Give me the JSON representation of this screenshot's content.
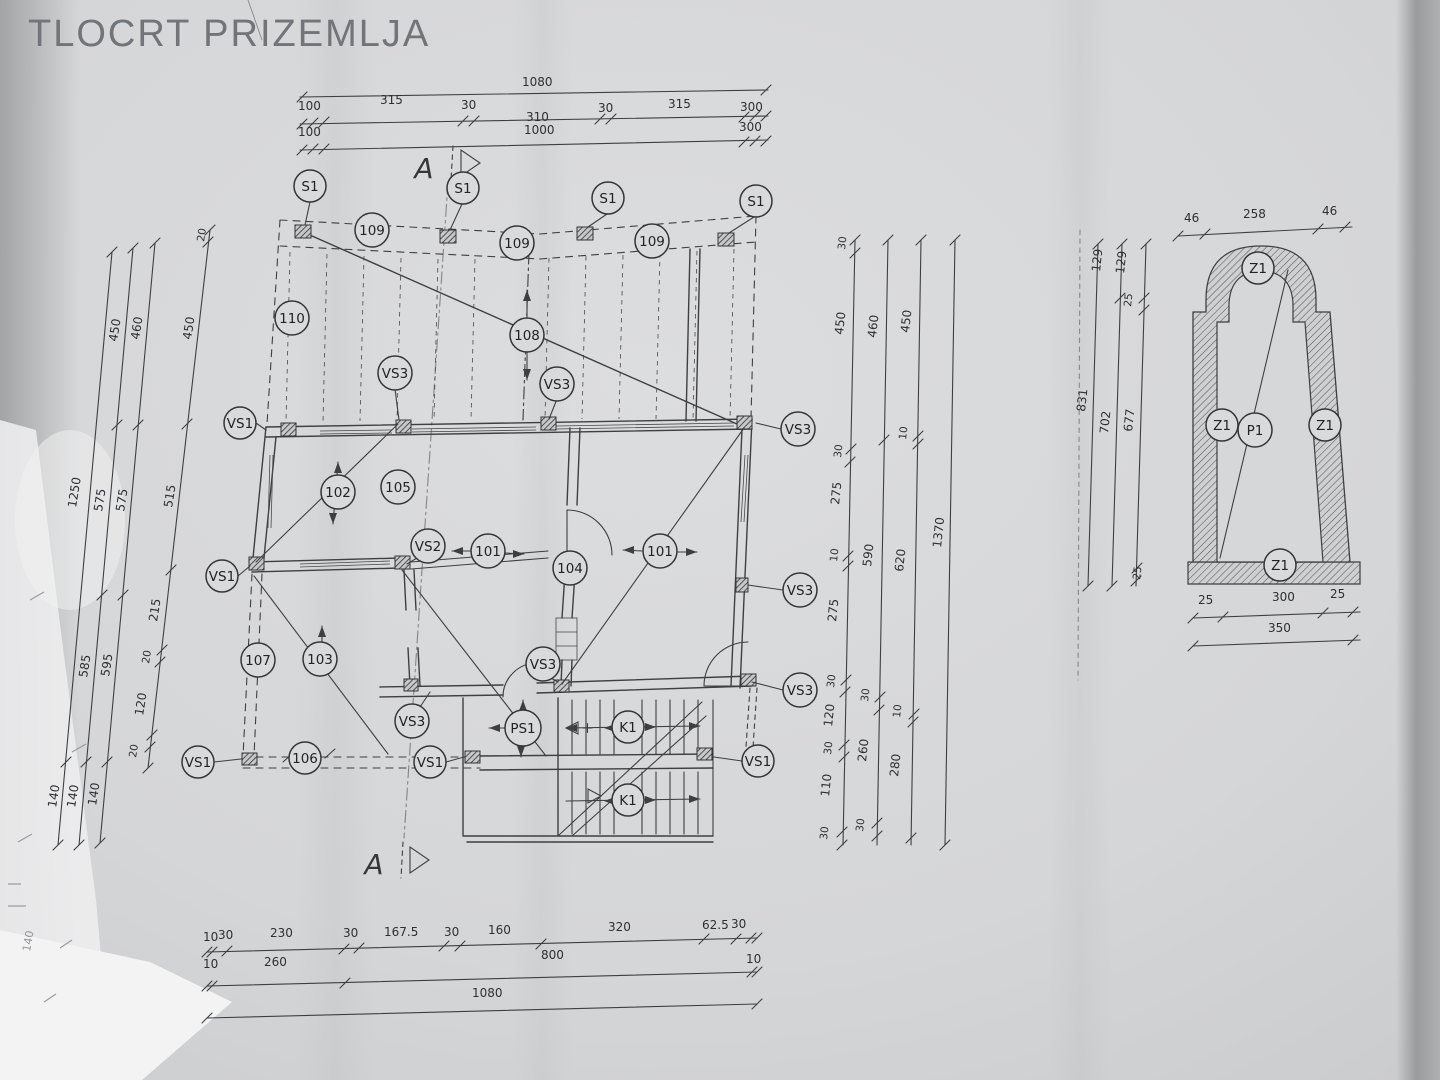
{
  "title": "TLOCRT PRIZEMLJA",
  "section_letter": "A",
  "labels": {
    "s1": "S1",
    "vs1": "VS1",
    "vs2": "VS2",
    "vs3": "VS3",
    "ps1": "PS1",
    "k1": "K1",
    "z1": "Z1",
    "p1": "P1",
    "n101": "101",
    "n102": "102",
    "n103": "103",
    "n104": "104",
    "n105": "105",
    "n106": "106",
    "n107": "107",
    "n108": "108",
    "n109": "109",
    "n110": "110"
  },
  "dims": {
    "top": {
      "total": "1080",
      "row2": [
        "100",
        "315",
        "30",
        "310",
        "30",
        "315",
        "300"
      ],
      "row3": [
        "100",
        "1000",
        "300"
      ]
    },
    "bottom": {
      "row1": [
        "10",
        "30",
        "230",
        "30",
        "167.5",
        "30",
        "160",
        "320",
        "62.5",
        "30"
      ],
      "row2": [
        "10",
        "260",
        "800",
        "10"
      ],
      "total": "1080"
    },
    "left": {
      "c0": [
        "1250",
        "140"
      ],
      "c1": [
        "450",
        "575",
        "585",
        "140"
      ],
      "c2": [
        "460",
        "575",
        "595",
        "140"
      ],
      "c3": [
        "20",
        "450",
        "515",
        "215",
        "20",
        "120",
        "20"
      ]
    },
    "right": {
      "a": [
        "30",
        "450",
        "30",
        "275",
        "10",
        "275",
        "30",
        "120",
        "30",
        "110",
        "30"
      ],
      "b": [
        "460",
        "590",
        "30",
        "260",
        "30"
      ],
      "c": [
        "450",
        "10",
        "620",
        "10",
        "280"
      ],
      "total": "1370"
    },
    "detail": {
      "top": [
        "46",
        "258",
        "46"
      ],
      "left_total": "831",
      "left_mid": [
        "129",
        "702"
      ],
      "left_inner": [
        "129",
        "25",
        "677",
        "25"
      ],
      "bottom": [
        "25",
        "300",
        "25"
      ],
      "bottom_total": "350"
    },
    "stray": "140"
  }
}
